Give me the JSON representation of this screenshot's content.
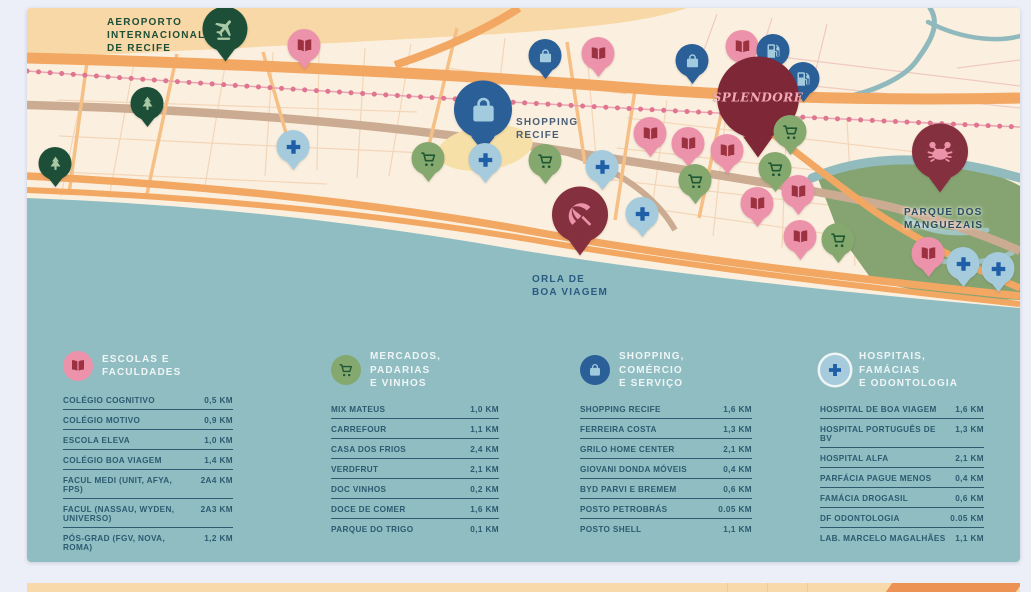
{
  "map": {
    "labels": {
      "airport": "AEROPORTO\nINTERNACIONAL\nDE RECIFE",
      "shopping_recife": "SHOPPING\nRECIFE",
      "orla": "ORLA DE\nBOA VIAGEM",
      "parque": "PARQUE DOS\nMANGUEZAIS",
      "splendore": "SPLENDORE"
    },
    "pin_types": {
      "school": {
        "icon": "book-icon",
        "bg": "#EC93AB",
        "fg": "#9C3140"
      },
      "market": {
        "icon": "cart-icon",
        "bg": "#85A86F",
        "fg": "#1F5735"
      },
      "shopping": {
        "icon": "bag-icon",
        "bg": "#2B5F98",
        "fg": "#A3CBE0"
      },
      "health": {
        "icon": "cross-icon",
        "bg": "#A5CBDC",
        "fg": "#1F5FA8"
      },
      "park": {
        "icon": "tree-icon",
        "bg": "#1D4F38",
        "fg": "#A9C8A4"
      },
      "airport": {
        "icon": "plane-icon",
        "bg": "#1D4F38",
        "fg": "#A9C8A4"
      },
      "fuel": {
        "icon": "fuel-icon",
        "bg": "#2B5F98",
        "fg": "#A3CBE0"
      },
      "mangrove": {
        "icon": "crab-icon",
        "bg": "#84303F",
        "fg": "#EC93AB"
      },
      "beach": {
        "icon": "umbrella-icon",
        "bg": "#84303F",
        "fg": "#EC93AB"
      },
      "splendore": {
        "icon": null,
        "bg": "#7E2737",
        "fg": "#F2A9B6"
      }
    },
    "markers": [
      {
        "type": "airport",
        "x": 198,
        "y": 26,
        "size": "lg"
      },
      {
        "type": "school",
        "x": 277,
        "y": 41
      },
      {
        "type": "park",
        "x": 120,
        "y": 99
      },
      {
        "type": "park",
        "x": 28,
        "y": 159
      },
      {
        "type": "health",
        "x": 266,
        "y": 142
      },
      {
        "type": "shopping",
        "x": 518,
        "y": 51
      },
      {
        "type": "school",
        "x": 571,
        "y": 49
      },
      {
        "type": "shopping",
        "x": 456,
        "y": 108,
        "size": "xl"
      },
      {
        "type": "market",
        "x": 401,
        "y": 154
      },
      {
        "type": "health",
        "x": 458,
        "y": 155
      },
      {
        "type": "market",
        "x": 518,
        "y": 156
      },
      {
        "type": "health",
        "x": 575,
        "y": 162
      },
      {
        "type": "shopping",
        "x": 665,
        "y": 56
      },
      {
        "type": "school",
        "x": 715,
        "y": 42
      },
      {
        "type": "fuel",
        "x": 746,
        "y": 46
      },
      {
        "type": "fuel",
        "x": 776,
        "y": 74
      },
      {
        "type": "splendore",
        "x": 731,
        "y": 99,
        "size": "xxl"
      },
      {
        "type": "school",
        "x": 623,
        "y": 129
      },
      {
        "type": "school",
        "x": 661,
        "y": 139
      },
      {
        "type": "school",
        "x": 700,
        "y": 146
      },
      {
        "type": "market",
        "x": 763,
        "y": 127
      },
      {
        "type": "market",
        "x": 748,
        "y": 164
      },
      {
        "type": "market",
        "x": 668,
        "y": 176
      },
      {
        "type": "school",
        "x": 771,
        "y": 187
      },
      {
        "type": "school",
        "x": 730,
        "y": 199
      },
      {
        "type": "health",
        "x": 615,
        "y": 209
      },
      {
        "type": "beach",
        "x": 553,
        "y": 213,
        "size": "ml"
      },
      {
        "type": "mangrove",
        "x": 913,
        "y": 150,
        "size": "ml"
      },
      {
        "type": "school",
        "x": 773,
        "y": 232
      },
      {
        "type": "market",
        "x": 811,
        "y": 235
      },
      {
        "type": "school",
        "x": 901,
        "y": 249
      },
      {
        "type": "health",
        "x": 936,
        "y": 259
      },
      {
        "type": "health",
        "x": 971,
        "y": 264
      }
    ]
  },
  "legend": {
    "sections": [
      {
        "title": "ESCOLAS E FACULDADES",
        "icon": "book-icon",
        "icon_bg": "#EC93AB",
        "icon_fg": "#9C3140",
        "ring": false,
        "items": [
          {
            "name": "COLÉGIO COGNITIVO",
            "distance": "0,5 KM"
          },
          {
            "name": "COLÉGIO MOTIVO",
            "distance": "0,9 KM"
          },
          {
            "name": "ESCOLA ELEVA",
            "distance": "1,0 KM"
          },
          {
            "name": "COLÉGIO BOA VIAGEM",
            "distance": "1,4 KM"
          },
          {
            "name": "FACUL MEDI (UNIT, AFYA, FPS)",
            "distance": "2A4 KM"
          },
          {
            "name": "FACUL (NASSAU, WYDEN, UNIVERSO)",
            "distance": "2A3 KM"
          },
          {
            "name": "PÓS-GRAD (FGV, NOVA, ROMA)",
            "distance": "1,2 KM"
          }
        ]
      },
      {
        "title": "MERCADOS, PADARIAS\nE VINHOS",
        "icon": "cart-icon",
        "icon_bg": "#85A86F",
        "icon_fg": "#1F5735",
        "ring": false,
        "items": [
          {
            "name": "MIX MATEUS",
            "distance": "1,0 KM"
          },
          {
            "name": "CARREFOUR",
            "distance": "1,1 KM"
          },
          {
            "name": "CASA DOS FRIOS",
            "distance": "2,4 KM"
          },
          {
            "name": "VERDFRUT",
            "distance": "2,1 KM"
          },
          {
            "name": "DOC VINHOS",
            "distance": "0,2 KM"
          },
          {
            "name": "DOCE DE COMER",
            "distance": "1,6 KM"
          },
          {
            "name": "PARQUE DO TRIGO",
            "distance": "0,1 KM"
          }
        ]
      },
      {
        "title": "SHOPPING, COMÉRCIO\nE SERVIÇO",
        "icon": "bag-icon",
        "icon_bg": "#2B5F98",
        "icon_fg": "#A3CBE0",
        "ring": false,
        "items": [
          {
            "name": "SHOPPING RECIFE",
            "distance": "1,6 KM"
          },
          {
            "name": "FERREIRA COSTA",
            "distance": "1,3 KM"
          },
          {
            "name": "GRILO HOME CENTER",
            "distance": "2,1 KM"
          },
          {
            "name": "GIOVANI DONDA MÓVEIS",
            "distance": "0,4 KM"
          },
          {
            "name": "BYD PARVI E BREMEM",
            "distance": "0,6 KM"
          },
          {
            "name": "POSTO PETROBRÁS",
            "distance": "0.05 KM"
          },
          {
            "name": "POSTO SHELL",
            "distance": "1,1 KM"
          }
        ]
      },
      {
        "title": "HOSPITAIS, FAMÁCIAS\nE ODONTOLOGIA",
        "icon": "cross-icon",
        "icon_bg": "#A5CBDC",
        "icon_fg": "#1F5FA8",
        "ring": true,
        "items": [
          {
            "name": "HOSPITAL DE BOA VIAGEM",
            "distance": "1,6 KM"
          },
          {
            "name": "HOSPITAL PORTUGUÊS DE BV",
            "distance": "1,3 KM"
          },
          {
            "name": "HOSPITAL ALFA",
            "distance": "2,1 KM"
          },
          {
            "name": "PARFÁCIA PAGUE MENOS",
            "distance": "0,4 KM"
          },
          {
            "name": "FAMÁCIA DROGASIL",
            "distance": "0,6 KM"
          },
          {
            "name": "DF ODONTOLOGIA",
            "distance": "0.05 KM"
          },
          {
            "name": "LAB. MARCELO MAGALHÃES",
            "distance": "1,1 KM"
          }
        ]
      }
    ]
  },
  "colors": {
    "page_bg": "#ECEFF8",
    "land_cream": "#FBF0DF",
    "land_peach": "#F8D8A6",
    "water_teal": "#8FBDC2",
    "park_green": "#86A472",
    "road_orange": "#F2A762",
    "road_tan": "#CBAC92",
    "metro_pink": "#DF7590",
    "legend_text": "#2E5A70"
  }
}
